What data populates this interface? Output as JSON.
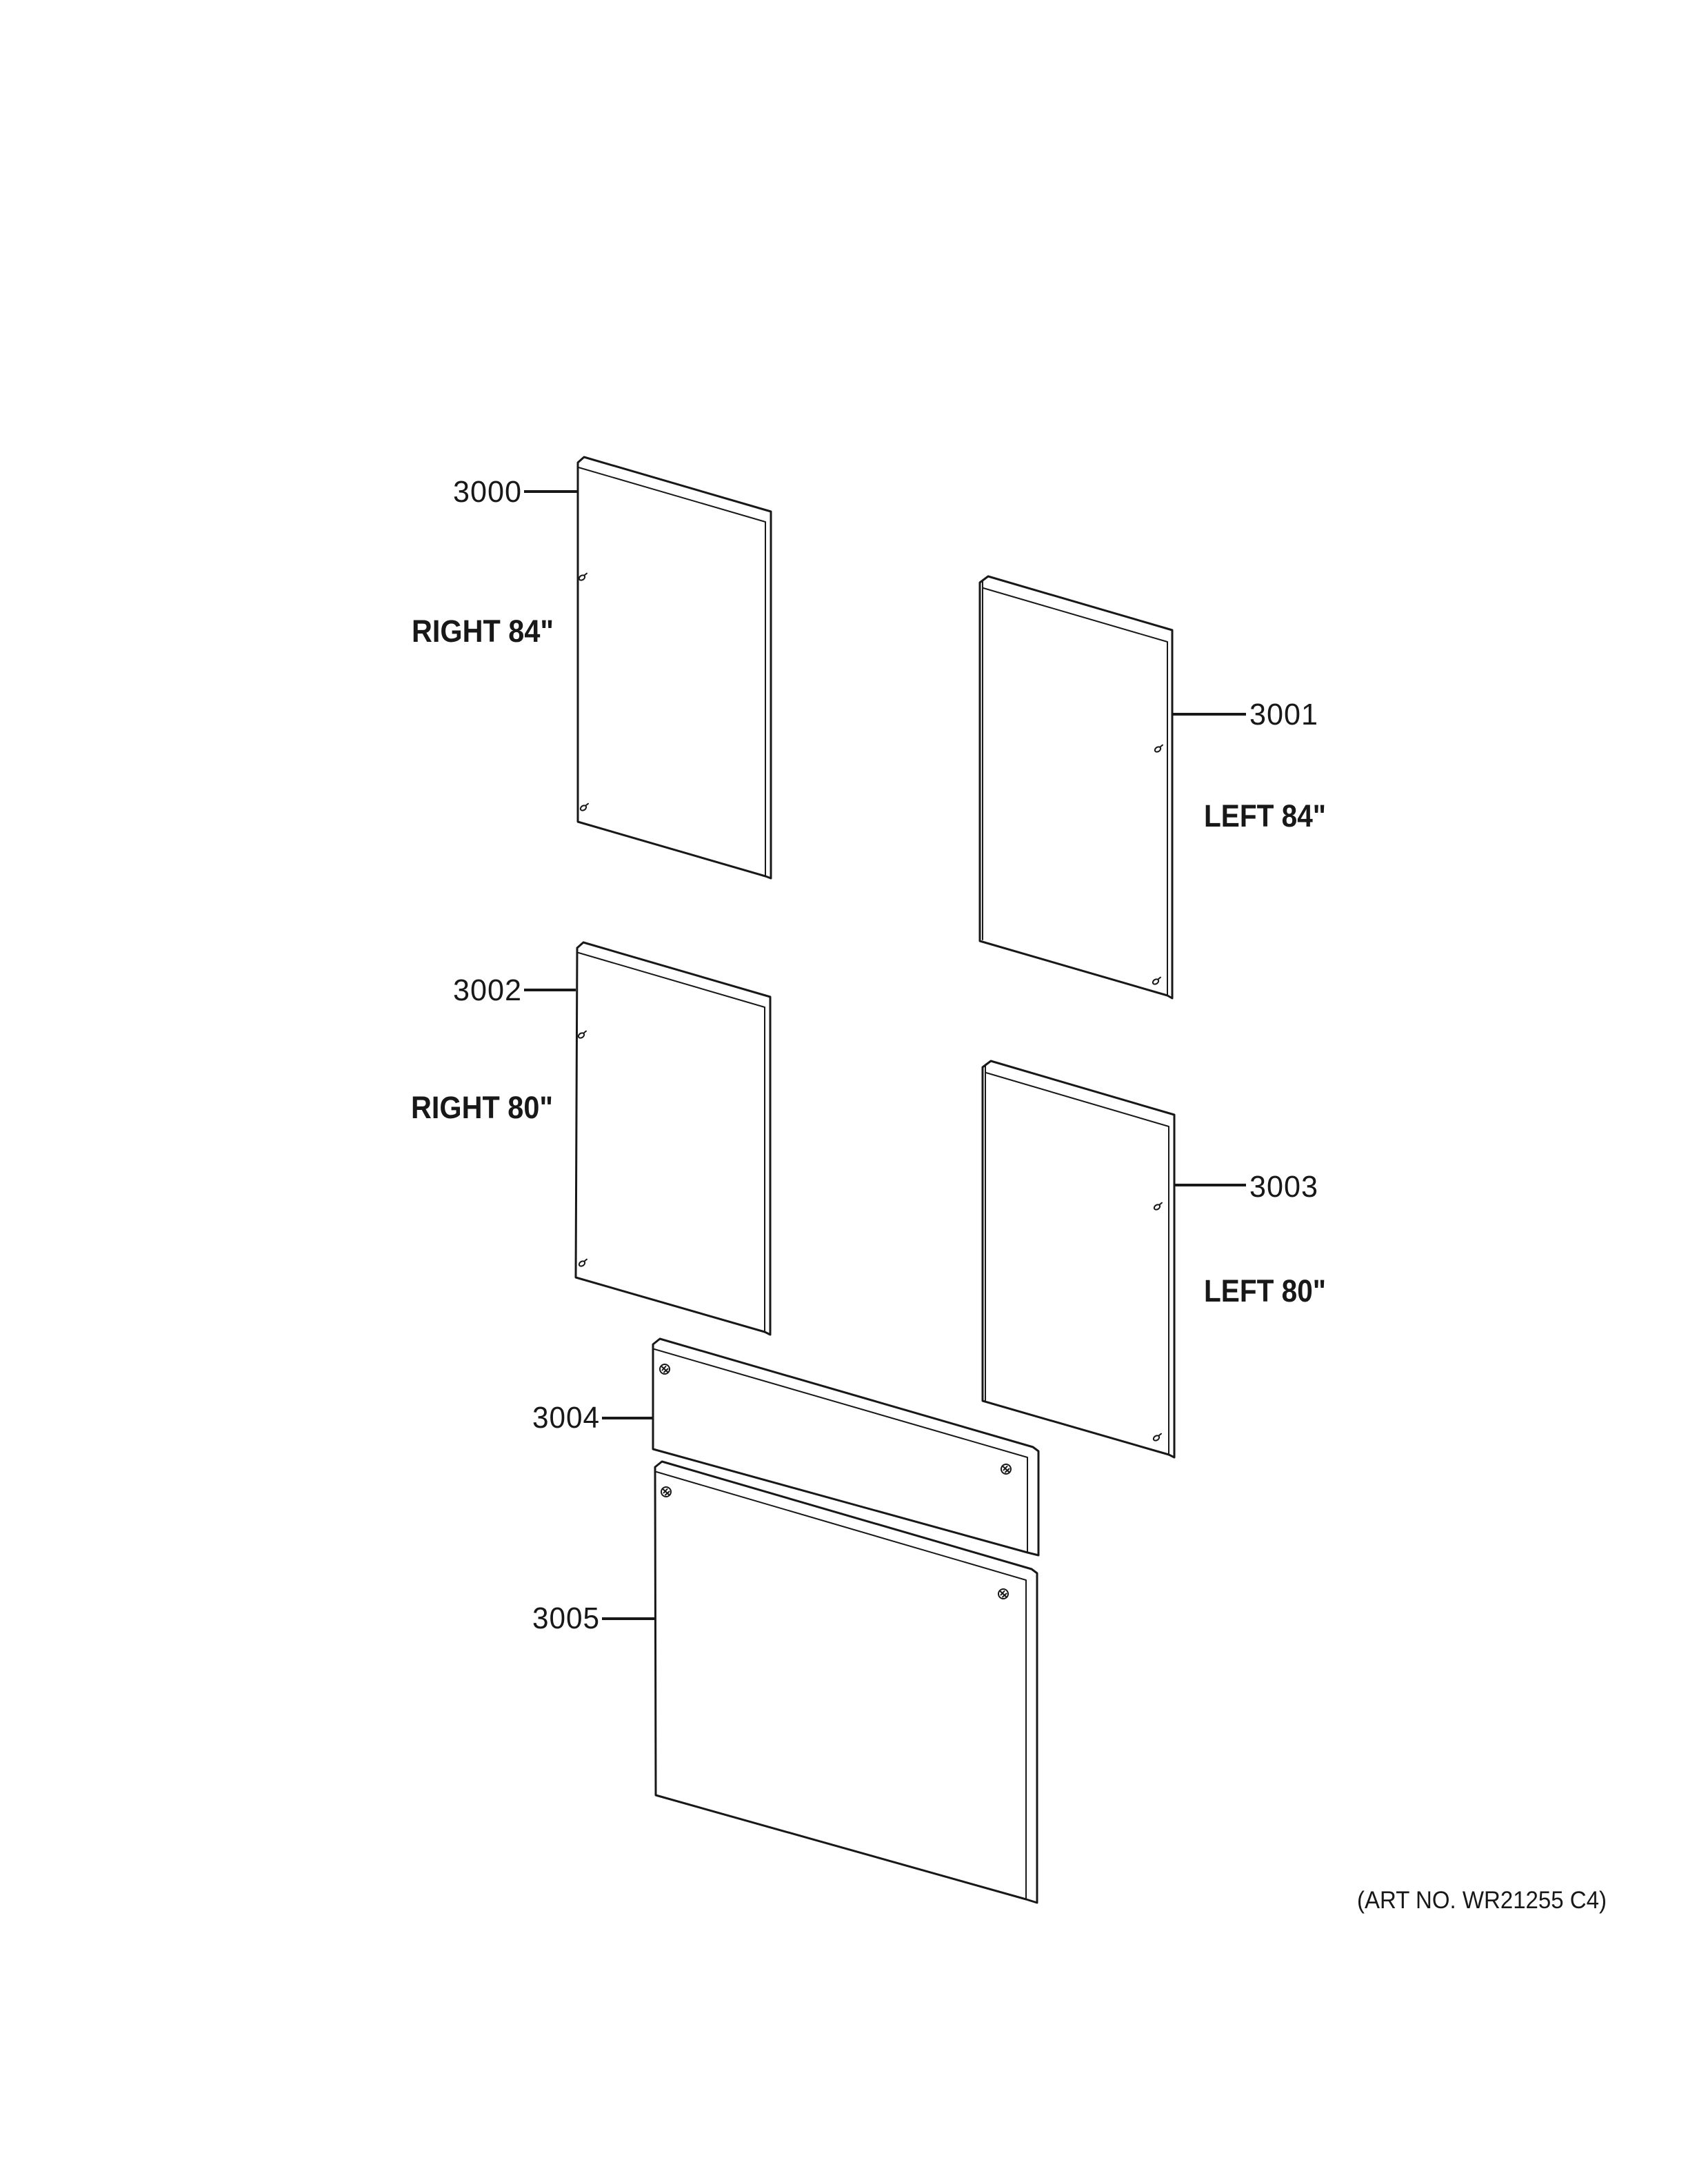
{
  "diagram_title": "Door trim panels exploded parts diagram",
  "parts": {
    "p3000": {
      "num": "3000",
      "size_label": "RIGHT 84\""
    },
    "p3001": {
      "num": "3001",
      "size_label": "LEFT 84\""
    },
    "p3002": {
      "num": "3002",
      "size_label": "RIGHT 80\""
    },
    "p3003": {
      "num": "3003",
      "size_label": "LEFT 80\""
    },
    "p3004": {
      "num": "3004"
    },
    "p3005": {
      "num": "3005"
    }
  },
  "footer": {
    "art_no": "(ART NO. WR21255 C4)"
  },
  "icons": {
    "screw": "screw-icon"
  },
  "colors": {
    "line": "#181818",
    "background": "#ffffff"
  }
}
